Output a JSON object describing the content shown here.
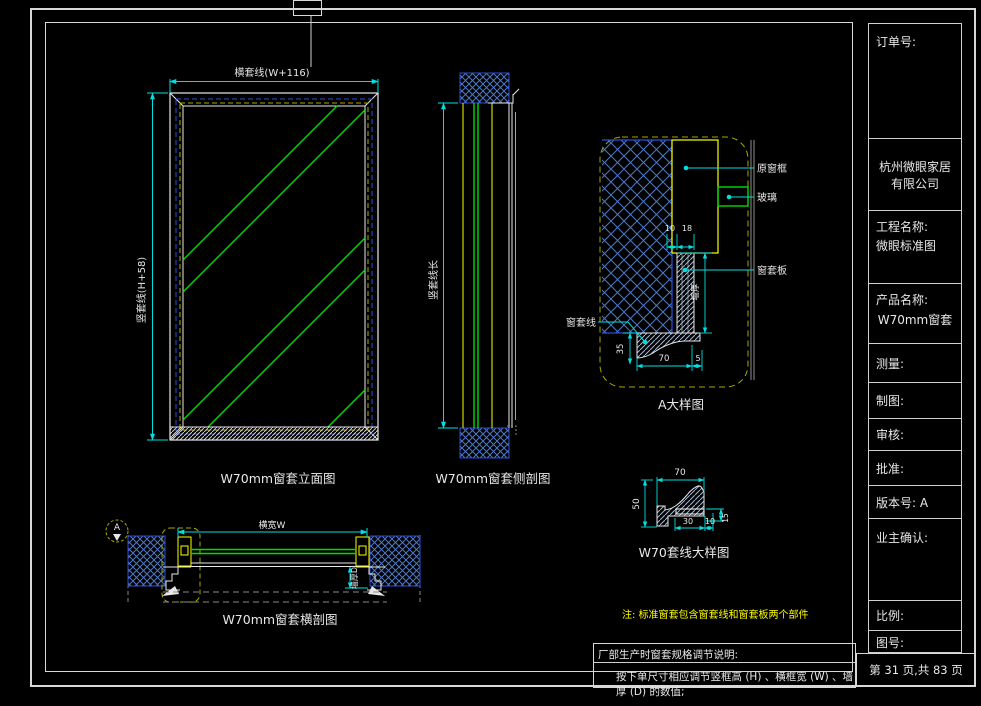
{
  "title_block": {
    "order_label": "订单号:",
    "company_line1": "杭州微眼家居",
    "company_line2": "有限公司",
    "project_label": "工程名称:",
    "project_value": "微眼标准图",
    "product_label": "产品名称:",
    "product_value": "W70mm窗套",
    "measure_label": "测量:",
    "draft_label": "制图:",
    "review_label": "审核:",
    "approve_label": "批准:",
    "version_label": "版本号: A",
    "owner_label": "业主确认:",
    "scale_label": "比例:",
    "drawing_no_label": "图号:",
    "page_info": "第 31 页,共 83 页"
  },
  "views": {
    "elevation": {
      "caption": "W70mm窗套立面图",
      "dim_top": "横套线(W+116)",
      "dim_left": "竖套线(H+58)"
    },
    "side_section": {
      "caption": "W70mm窗套侧剖图",
      "dim_left": "竖套线长"
    },
    "detail_a": {
      "caption": "A大样图",
      "label_frame": "原窗框",
      "label_glass": "玻璃",
      "label_board": "窗套板",
      "label_line": "窗套线",
      "dim_10": "10",
      "dim_18": "18",
      "dim_35": "35",
      "dim_70": "70",
      "dim_5": "5",
      "dim_wall": "墙厚"
    },
    "horizontal_section": {
      "caption": "W70mm窗套横剖图",
      "dim_top": "横宽W",
      "dim_right": "墙厚D",
      "callout": "A"
    },
    "line_detail": {
      "caption": "W70套线大样图",
      "dim_top": "70",
      "dim_left": "50",
      "dim_bottom1": "30",
      "dim_bottom2": "10",
      "dim_right": "15"
    }
  },
  "notes": {
    "standard_note": "注: 标准窗套包含窗套线和窗套板两个部件",
    "box_title": "厂部生产时窗套规格调节说明:",
    "box_content": "按下单尺寸相应调节竖框高 (H) 、横框宽 (W) 、墙厚 (D) 的数值;"
  },
  "colors": {
    "dimension": "#00e0e0",
    "glass": "#00dd00",
    "frame": "#ffff00",
    "wall_hatch": "#4d79c7",
    "line_white": "#e8e8e8"
  }
}
